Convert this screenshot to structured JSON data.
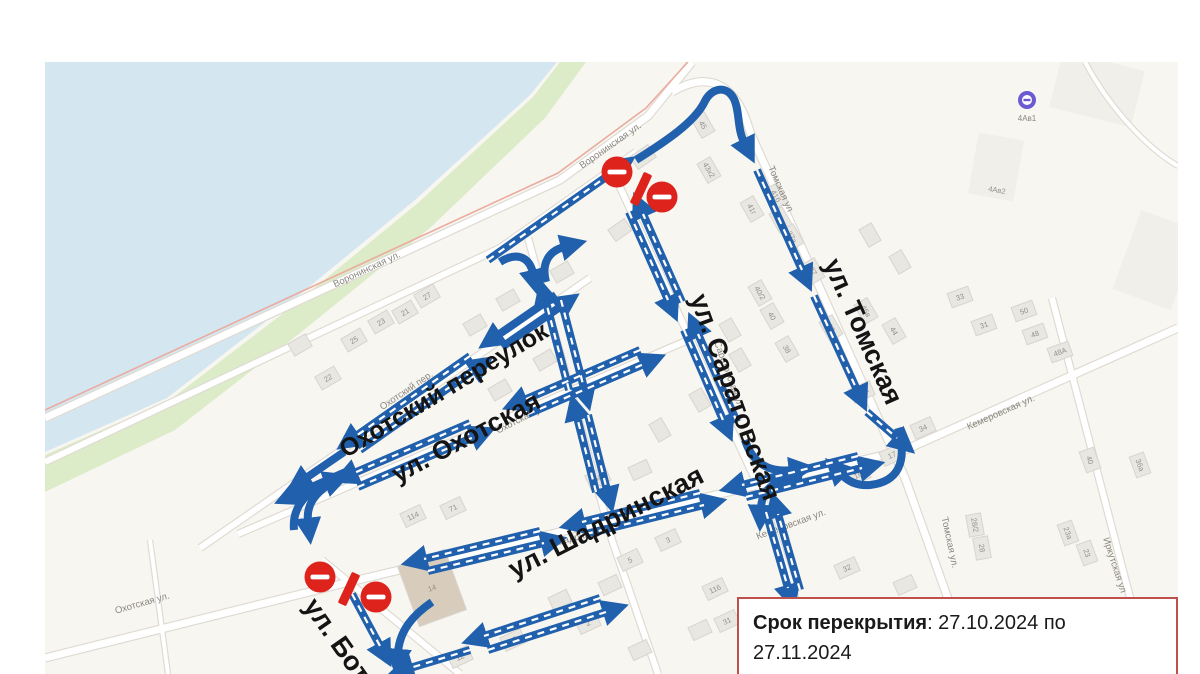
{
  "map": {
    "colors": {
      "water": "#d4e6f0",
      "shore_green": "#dcebc8",
      "land": "#f8f6f1",
      "road_fill": "#ffffff",
      "road_edge": "#dfdbd3",
      "highway_line": "#ecab9f",
      "arrow_blue": "#2060ac",
      "sign_red": "#de231c",
      "building_fill": "#e9e7e2",
      "building_edge": "#d8d5ce",
      "building_tan": "#d8cdbd",
      "transit_purple": "#6b5bd2",
      "label_minor": "#8a867f",
      "label_major": "#141414"
    },
    "info_box": {
      "label": "Срок перекрытия",
      "line1_rest": ": 27.10.2024  по",
      "line2": "27.11.2024",
      "border": "#c0504d"
    },
    "poi": {
      "stop_label": "4Ав1"
    },
    "labels_major": [
      {
        "text": "ул. Томская",
        "x": 855,
        "y": 335,
        "r": 66,
        "s": 27
      },
      {
        "text": "ул. Саратовская",
        "x": 727,
        "y": 400,
        "r": 70,
        "s": 27
      },
      {
        "text": "Охотский переулок",
        "x": 448,
        "y": 397,
        "r": -31,
        "s": 25
      },
      {
        "text": "ул. Охотская",
        "x": 470,
        "y": 445,
        "r": -28,
        "s": 26
      },
      {
        "text": "ул. Шадринская",
        "x": 610,
        "y": 530,
        "r": -27,
        "s": 27
      },
      {
        "text": "ул. Бот",
        "x": 330,
        "y": 645,
        "r": 55,
        "s": 27
      }
    ],
    "labels_minor": [
      {
        "text": "Воронинская ул.",
        "x": 368,
        "y": 272,
        "r": -25
      },
      {
        "text": "Воронинская ул.",
        "x": 612,
        "y": 148,
        "r": -35
      },
      {
        "text": "Охотский пер.",
        "x": 408,
        "y": 393,
        "r": -34
      },
      {
        "text": "Охотская ул.",
        "x": 523,
        "y": 421,
        "r": -27
      },
      {
        "text": "Охотская ул.",
        "x": 143,
        "y": 606,
        "r": -16
      },
      {
        "text": "Шадринская ул.",
        "x": 590,
        "y": 537,
        "r": -14
      },
      {
        "text": "Кемеровская ул.",
        "x": 792,
        "y": 527,
        "r": -20
      },
      {
        "text": "Кемеровская ул.",
        "x": 1002,
        "y": 415,
        "r": -24
      },
      {
        "text": "Томская ул.",
        "x": 947,
        "y": 543,
        "r": 78
      },
      {
        "text": "Иркутская ул",
        "x": 1112,
        "y": 566,
        "r": 72
      },
      {
        "text": "Томская ул",
        "x": 778,
        "y": 190,
        "r": 66
      },
      {
        "text": "Саратовская ул",
        "x": 726,
        "y": 375,
        "r": 70
      }
    ],
    "buildings": [
      {
        "n": "25",
        "x": 354,
        "y": 340,
        "r": -30
      },
      {
        "n": "23",
        "x": 381,
        "y": 322,
        "r": -30
      },
      {
        "n": "21",
        "x": 405,
        "y": 312,
        "r": -30
      },
      {
        "n": "22",
        "x": 328,
        "y": 378,
        "r": -30
      },
      {
        "n": "27",
        "x": 427,
        "y": 296,
        "r": -30
      },
      {
        "n": "50",
        "x": 643,
        "y": 157,
        "r": -35
      },
      {
        "n": "45",
        "x": 703,
        "y": 125,
        "r": 60
      },
      {
        "n": "43х2",
        "x": 709,
        "y": 170,
        "r": 60
      },
      {
        "n": "41б",
        "x": 776,
        "y": 196,
        "r": 60
      },
      {
        "n": "41г",
        "x": 752,
        "y": 209,
        "r": 60
      },
      {
        "n": "39а",
        "x": 781,
        "y": 220,
        "r": 60
      },
      {
        "n": "37а",
        "x": 792,
        "y": 237,
        "r": 60
      },
      {
        "n": "37",
        "x": 813,
        "y": 271,
        "r": 60
      },
      {
        "n": "40/2",
        "x": 760,
        "y": 293,
        "r": 60
      },
      {
        "n": "40",
        "x": 772,
        "y": 316,
        "r": 60
      },
      {
        "n": "38",
        "x": 787,
        "y": 349,
        "r": 60
      },
      {
        "n": "33",
        "x": 831,
        "y": 328,
        "r": 60
      },
      {
        "n": "46в",
        "x": 866,
        "y": 311,
        "r": 60
      },
      {
        "n": "44",
        "x": 894,
        "y": 331,
        "r": 60
      },
      {
        "n": "33",
        "x": 960,
        "y": 297,
        "r": -20
      },
      {
        "n": "50",
        "x": 1024,
        "y": 311,
        "r": -20
      },
      {
        "n": "31",
        "x": 984,
        "y": 325,
        "r": -20
      },
      {
        "n": "48",
        "x": 1035,
        "y": 334,
        "r": -20
      },
      {
        "n": "48А",
        "x": 1060,
        "y": 352,
        "r": -20
      },
      {
        "n": "21А",
        "x": 862,
        "y": 392,
        "r": -24
      },
      {
        "n": "34",
        "x": 923,
        "y": 428,
        "r": -24
      },
      {
        "n": "17",
        "x": 892,
        "y": 455,
        "r": -24
      },
      {
        "n": "16",
        "x": 858,
        "y": 475,
        "r": -24
      },
      {
        "n": "32",
        "x": 847,
        "y": 568,
        "r": -24
      },
      {
        "n": "40",
        "x": 1090,
        "y": 460,
        "r": 70
      },
      {
        "n": "23а",
        "x": 1068,
        "y": 533,
        "r": 70
      },
      {
        "n": "23",
        "x": 1087,
        "y": 553,
        "r": 70
      },
      {
        "n": "28/2",
        "x": 975,
        "y": 525,
        "r": 80
      },
      {
        "n": "28",
        "x": 982,
        "y": 548,
        "r": 80
      },
      {
        "n": "36а",
        "x": 1140,
        "y": 465,
        "r": 70
      },
      {
        "n": "114",
        "x": 413,
        "y": 516,
        "r": -25
      },
      {
        "n": "71",
        "x": 453,
        "y": 508,
        "r": -25
      },
      {
        "n": "6А",
        "x": 598,
        "y": 478,
        "r": -25
      },
      {
        "n": "12",
        "x": 460,
        "y": 657,
        "r": -25
      },
      {
        "n": "15",
        "x": 513,
        "y": 640,
        "r": -25
      },
      {
        "n": "3",
        "x": 668,
        "y": 540,
        "r": -25
      },
      {
        "n": "5",
        "x": 630,
        "y": 560,
        "r": -25
      },
      {
        "n": "2",
        "x": 588,
        "y": 623,
        "r": -25
      },
      {
        "n": "116",
        "x": 715,
        "y": 589,
        "r": -25
      },
      {
        "n": "31",
        "x": 727,
        "y": 621,
        "r": -25
      },
      {
        "n": "9",
        "x": 950,
        "y": 650,
        "r": -24
      },
      {
        "n": "14",
        "x": 432,
        "y": 588,
        "r": -20,
        "w": 50,
        "h": 64,
        "tan": true
      },
      {
        "n": "4Ав2",
        "x": 997,
        "y": 190,
        "r": 10,
        "w": 44,
        "h": 58,
        "pale": true
      }
    ],
    "signs": {
      "no_entry": [
        [
          617,
          172
        ],
        [
          662,
          197
        ],
        [
          320,
          577
        ],
        [
          376,
          597
        ]
      ],
      "closure_bars": [
        [
          641,
          189,
          25
        ],
        [
          349,
          589,
          25
        ]
      ]
    }
  }
}
